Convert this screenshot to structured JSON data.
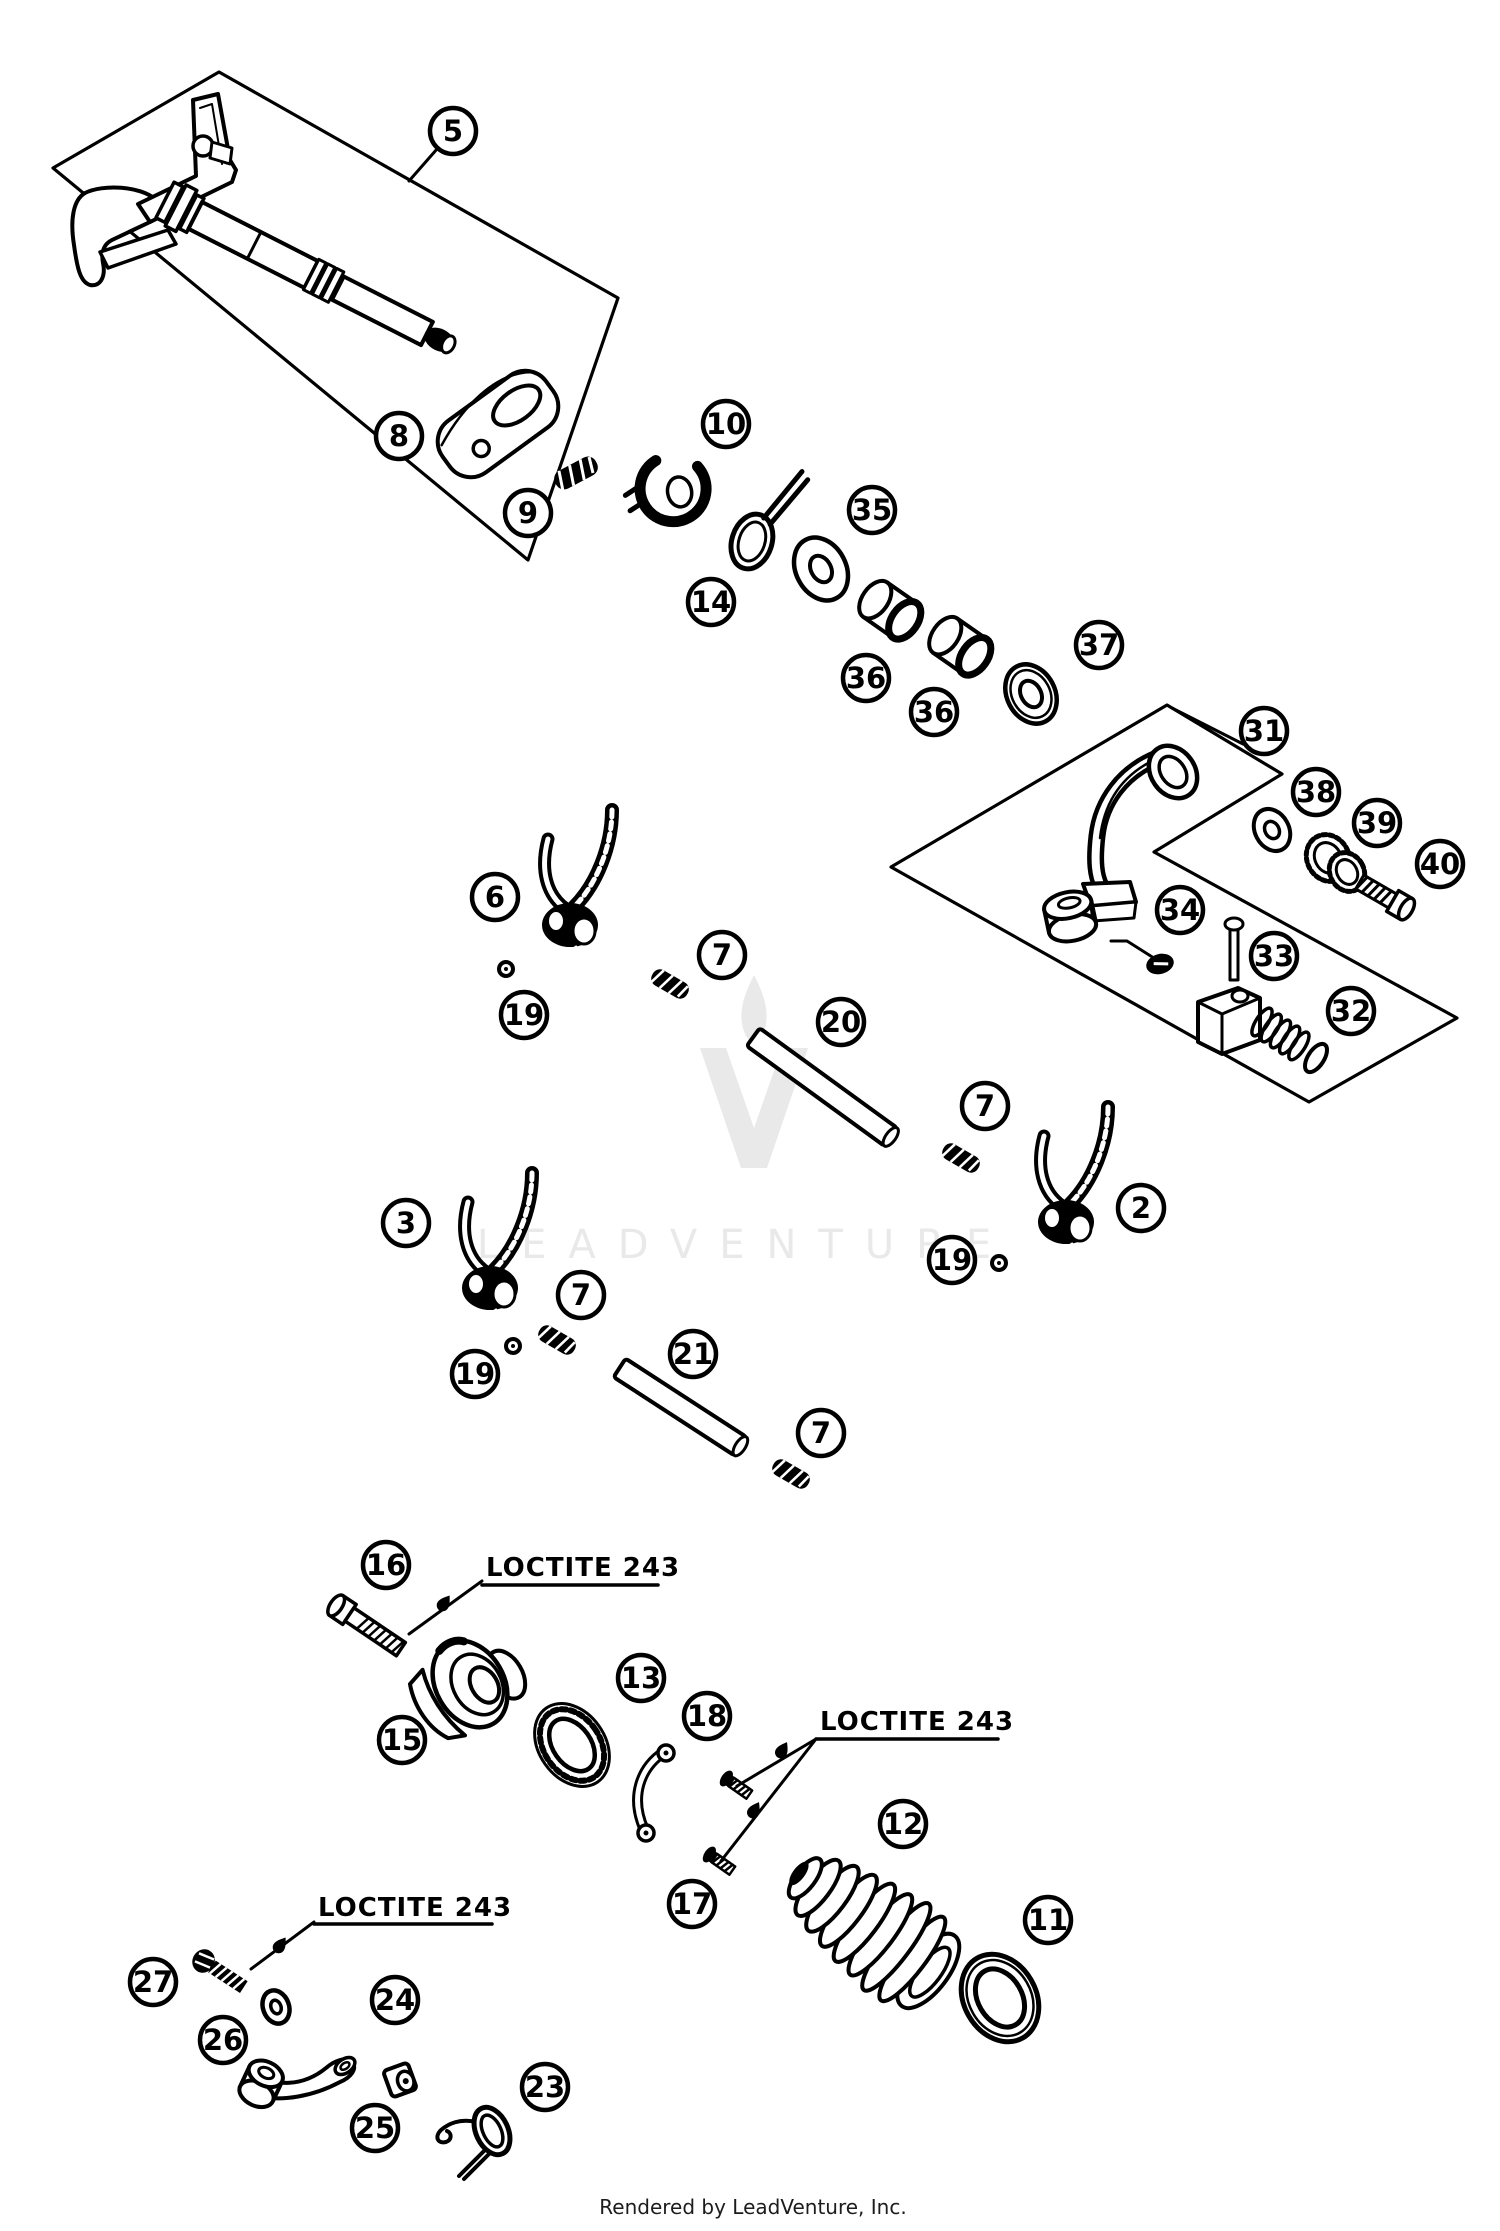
{
  "watermark": {
    "text": "LEADVENTURE",
    "logo_icon": "leadventure-v-flame-icon",
    "color": "#e9e9e9"
  },
  "footer": {
    "credit": "Rendered by LeadVenture, Inc."
  },
  "annotations": {
    "loctite_labels": [
      {
        "text": "LOCTITE 243"
      },
      {
        "text": "LOCTITE 243"
      },
      {
        "text": "LOCTITE 243"
      }
    ]
  },
  "colors": {
    "line": "#000000",
    "background": "#ffffff",
    "watermark": "#e9e9e9",
    "footer_text": "#1c1c1c"
  },
  "callouts": [
    {
      "label": "5",
      "x": 453,
      "y": 131
    },
    {
      "label": "8",
      "x": 399,
      "y": 436
    },
    {
      "label": "9",
      "x": 528,
      "y": 513
    },
    {
      "label": "10",
      "x": 726,
      "y": 424
    },
    {
      "label": "14",
      "x": 711,
      "y": 602
    },
    {
      "label": "35",
      "x": 872,
      "y": 510
    },
    {
      "label": "36",
      "x": 866,
      "y": 678
    },
    {
      "label": "36",
      "x": 934,
      "y": 712
    },
    {
      "label": "37",
      "x": 1099,
      "y": 645
    },
    {
      "label": "31",
      "x": 1264,
      "y": 731
    },
    {
      "label": "38",
      "x": 1316,
      "y": 792
    },
    {
      "label": "39",
      "x": 1377,
      "y": 823
    },
    {
      "label": "40",
      "x": 1440,
      "y": 864
    },
    {
      "label": "34",
      "x": 1180,
      "y": 910
    },
    {
      "label": "33",
      "x": 1274,
      "y": 956
    },
    {
      "label": "32",
      "x": 1351,
      "y": 1011
    },
    {
      "label": "6",
      "x": 495,
      "y": 897
    },
    {
      "label": "19",
      "x": 524,
      "y": 1015
    },
    {
      "label": "7",
      "x": 722,
      "y": 955
    },
    {
      "label": "20",
      "x": 841,
      "y": 1022
    },
    {
      "label": "7",
      "x": 985,
      "y": 1106
    },
    {
      "label": "2",
      "x": 1141,
      "y": 1208
    },
    {
      "label": "19",
      "x": 952,
      "y": 1260
    },
    {
      "label": "3",
      "x": 406,
      "y": 1223
    },
    {
      "label": "7",
      "x": 581,
      "y": 1295
    },
    {
      "label": "19",
      "x": 475,
      "y": 1374
    },
    {
      "label": "21",
      "x": 693,
      "y": 1354
    },
    {
      "label": "7",
      "x": 821,
      "y": 1433
    },
    {
      "label": "16",
      "x": 386,
      "y": 1565
    },
    {
      "label": "15",
      "x": 402,
      "y": 1740
    },
    {
      "label": "13",
      "x": 641,
      "y": 1678
    },
    {
      "label": "18",
      "x": 707,
      "y": 1716
    },
    {
      "label": "17",
      "x": 692,
      "y": 1904
    },
    {
      "label": "12",
      "x": 903,
      "y": 1824
    },
    {
      "label": "11",
      "x": 1048,
      "y": 1920
    },
    {
      "label": "27",
      "x": 153,
      "y": 1982
    },
    {
      "label": "26",
      "x": 223,
      "y": 2040
    },
    {
      "label": "24",
      "x": 395,
      "y": 2000
    },
    {
      "label": "25",
      "x": 375,
      "y": 2128
    },
    {
      "label": "23",
      "x": 545,
      "y": 2087
    }
  ]
}
